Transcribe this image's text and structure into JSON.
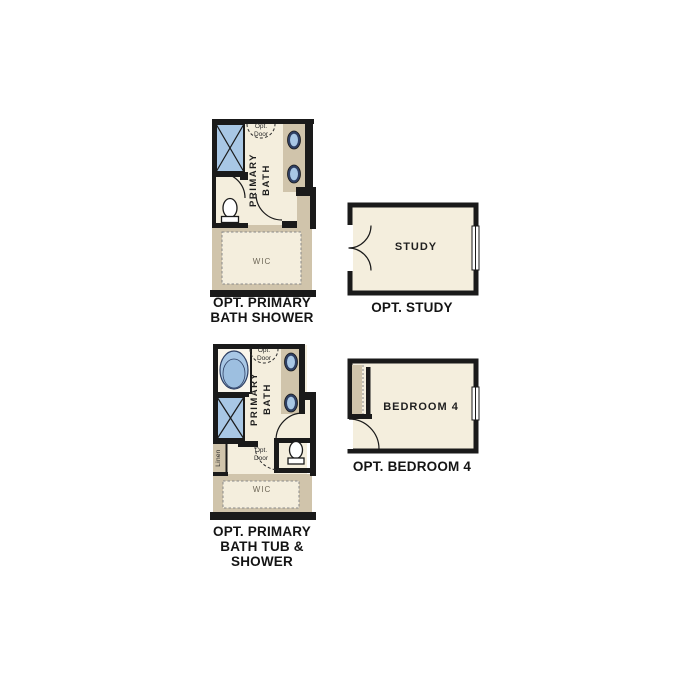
{
  "page": {
    "background": "#ffffff"
  },
  "colors": {
    "wall": "#1a1a1a",
    "floor": "#f4eedd",
    "counter_tan": "#d0c4ab",
    "fixture_blue": "#a8c7e5",
    "tub_inner_blue": "#9dbfe0",
    "sink_rim_navy": "#2e3f63",
    "dashed_gray": "#8a8a8a",
    "caption_text": "#141414"
  },
  "plans": {
    "bath_shower": {
      "caption": "OPT. PRIMARY\nBATH SHOWER",
      "room_label": "PRIMARY\nBATH",
      "wic_label": "WIC",
      "opt_door_label": "Opt.\nDoor"
    },
    "study": {
      "caption": "OPT. STUDY",
      "room_label": "STUDY"
    },
    "bath_tub_shower": {
      "caption": "OPT. PRIMARY\nBATH TUB &\nSHOWER",
      "room_label": "PRIMARY\nBATH",
      "wic_label": "WIC",
      "linen_label": "Linen",
      "opt_door_top_label": "Opt.\nDoor",
      "opt_door_mid_label": "Opt.\nDoor"
    },
    "bedroom4": {
      "caption": "OPT. BEDROOM 4",
      "room_label": "BEDROOM 4"
    }
  }
}
